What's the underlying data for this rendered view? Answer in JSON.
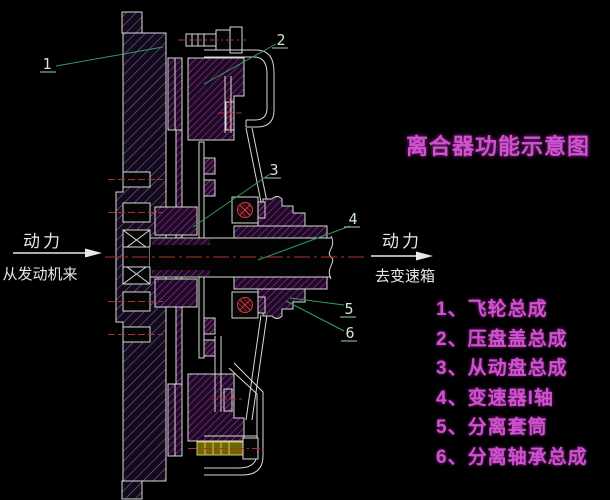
{
  "title": {
    "text": "离合器功能示意图"
  },
  "power_flow": {
    "left": {
      "top": "动力",
      "bottom": "从发动机来"
    },
    "right": {
      "top": "动力",
      "bottom": "去变速箱"
    }
  },
  "callouts": [
    "1",
    "2",
    "3",
    "4",
    "5",
    "6"
  ],
  "legend": {
    "items": [
      "1、飞轮总成",
      "2、压盘盖总成",
      "3、从动盘总成",
      "4、变速器I轴",
      "5、分离套筒",
      "6、分离轴承总成"
    ]
  },
  "colors": {
    "background": "#000000",
    "outline_white": "#d9d9d9",
    "hatch_flywheel": "#7d6b94",
    "hatch_magenta": "#ad3cb4",
    "centerline_red": "#b03030",
    "leader_green": "#2f9e60",
    "text_magenta": "#cf52cf",
    "text_white": "#e8e8e8",
    "bolt_yellow": "#d6c75a",
    "bearing_red": "#c24040"
  },
  "diagram": {
    "type": "clutch-cross-section",
    "view": "side section"
  }
}
